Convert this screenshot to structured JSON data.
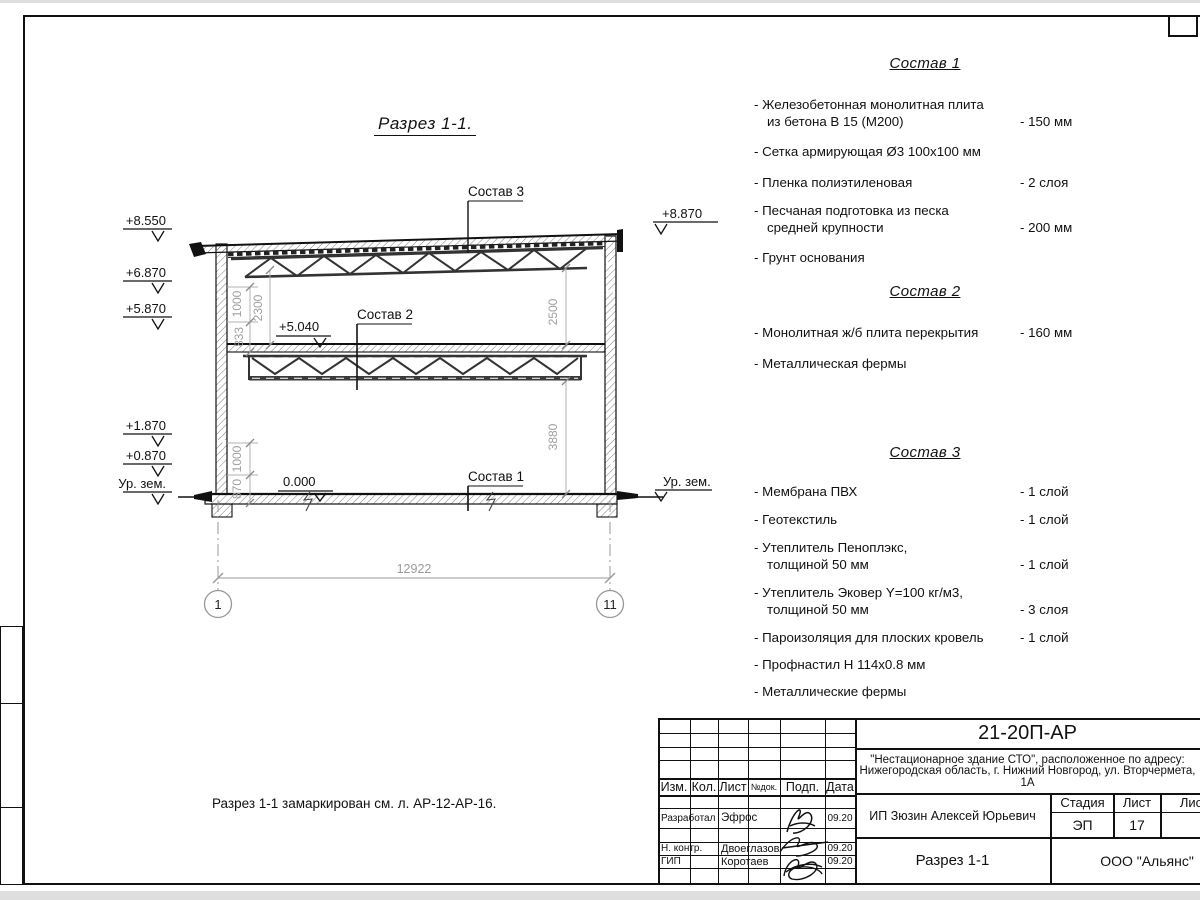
{
  "drawing": {
    "title": "Разрез 1-1.",
    "levels": {
      "l8550": "+8.550",
      "l6870": "+6.870",
      "l5870": "+5.870",
      "l1870": "+1.870",
      "l0870": "+0.870",
      "ground_left": "Ур. зем.",
      "l8870": "+8.870",
      "ground_right": "Ур. зем.",
      "l5040": "+5.040",
      "l0000": "0.000"
    },
    "labels": {
      "sostav1": "Состав 1",
      "sostav2": "Состав 2",
      "sostav3": "Состав 3"
    },
    "dims": {
      "d1000u": "1000",
      "d833": "833",
      "d2300": "2300",
      "d2500": "2500",
      "d3880": "3880",
      "d1000l": "1000",
      "d870": "870",
      "d12922": "12922"
    },
    "axes": {
      "a1": "1",
      "a11": "11"
    }
  },
  "note": "Разрез 1-1 замаркирован см. л. АР-12-АР-16.",
  "compositions": [
    {
      "title": "Состав 1",
      "items": [
        {
          "name": "- Железобетонная  монолитная плита\nиз бетона В 15 (М200)",
          "value": "- 150 мм"
        },
        {
          "name": "- Сетка армирующая Ø3 100х100 мм",
          "value": ""
        },
        {
          "name": "- Пленка полиэтиленовая",
          "value": "-  2 слоя"
        },
        {
          "name": "- Песчаная подготовка из песка\nсредней крупности",
          "value": "- 200 мм"
        },
        {
          "name": "- Грунт основания",
          "value": ""
        }
      ]
    },
    {
      "title": "Состав 2",
      "items": [
        {
          "name": "- Монолитная ж/б плита перекрытия",
          "value": "- 160 мм"
        },
        {
          "name": "- Металлическая фермы",
          "value": ""
        }
      ]
    },
    {
      "title": "Состав 3",
      "items": [
        {
          "name": "- Мембрана ПВХ",
          "value": "- 1 слой"
        },
        {
          "name": "- Геотекстиль",
          "value": "- 1 слой"
        },
        {
          "name": "- Утеплитель Пеноплэкс,\nтолщиной 50 мм",
          "value": "- 1 слой"
        },
        {
          "name": "- Утеплитель Эковер Y=100 кг/м3,\nтолщиной 50 мм",
          "value": "- 3 слоя"
        },
        {
          "name": "- Пароизоляция для плоских кровель",
          "value": "- 1 слой"
        },
        {
          "name": "- Профнастил Н 114х0.8 мм",
          "value": ""
        },
        {
          "name": "- Металлические фермы",
          "value": ""
        }
      ]
    }
  ],
  "title_block": {
    "code": "21-20П-АР",
    "project_line1": "\"Нестационарное здание СТО\", расположенное по адресу:",
    "project_line2": "Нижегородская область, г. Нижний Новгород, ул. Вторчермета, 1А",
    "client": "ИП Зюзин Алексей Юрьевич",
    "sheet_title": "Разрез 1-1",
    "company": "ООО \"Альянс\"",
    "stage_label": "Стадия",
    "sheet_label": "Лист",
    "sheets_label": "Листов",
    "stage": "ЭП",
    "sheet_no": "17",
    "cols": [
      "Изм.",
      "Кол.",
      "Лист",
      "№док.",
      "Подп.",
      "Дата"
    ],
    "rows": [
      {
        "role": "Разработал",
        "name": "Эфрос",
        "date": "09.20"
      },
      {
        "role": "Н. контр.",
        "name": "Двоеглазов",
        "date": "09.20"
      },
      {
        "role": "ГИП",
        "name": "Коротаев",
        "date": "09.20"
      }
    ]
  }
}
